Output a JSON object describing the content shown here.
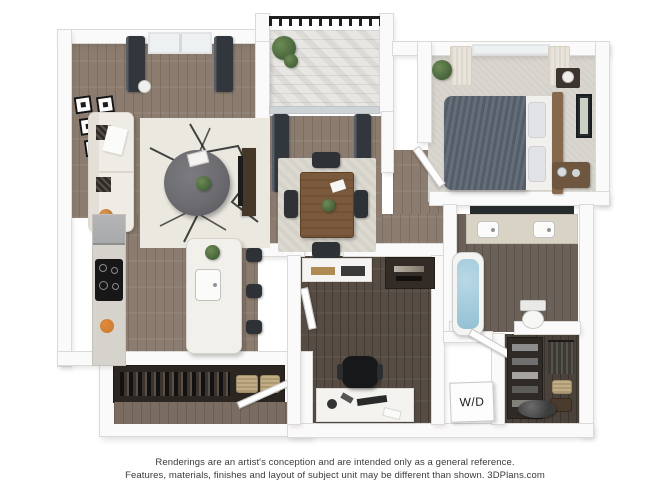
{
  "floorplan": {
    "type": "3d-apartment-floor-plan-rendering",
    "labels": {
      "washer_dryer": "W/D"
    },
    "rooms": [
      "living-room",
      "dining-area",
      "kitchen",
      "balcony",
      "bedroom",
      "bathroom",
      "den-office",
      "entry",
      "walk-in-closet",
      "laundry-nook"
    ],
    "furniture": [
      "sofa",
      "gallery-wall-frames",
      "area-rug",
      "round-ottoman",
      "media-console",
      "kitchen-island",
      "bar-stools",
      "cooktop",
      "refrigerator",
      "dining-table",
      "dining-chairs",
      "bed",
      "nightstand",
      "wall-art",
      "dresser",
      "double-vanity",
      "bathtub",
      "toilet",
      "desk",
      "office-chair",
      "closet-shelving",
      "baskets"
    ]
  },
  "disclaimer": {
    "line1": "Renderings are an artist's conception and are intended only as a general reference.",
    "line2": "Features, materials, finishes and layout of subject unit may be different than shown. 3DPlans.com"
  },
  "colors": {
    "wall": "#fbfafa",
    "wall-edge": "#dcdad7",
    "wood": "#8b7c6f",
    "wood-seam": "#6f6257",
    "wood-mid": "#7a6c60",
    "wood-dark": "#564c43",
    "closet-floor": "#4a423b",
    "carpet": "#d9d6d0",
    "bath-floor": "#6b6158",
    "deck": "#e8e6e2",
    "curtain-dark": "#3d434c",
    "curtain-light": "#e9e4da",
    "rug-living": "#ebe8e0",
    "rug-dining": "#dcd9d1",
    "duvet": "#59636f",
    "linen": "#f1f0ed",
    "pillow": "#e2e3e6",
    "headboard": "#86684c",
    "table-wood": "#7a593c",
    "chair-dark": "#2e3237",
    "ottoman": "#6c6b70",
    "console-wood": "#463829",
    "counter": "#d6d3cd",
    "island": "#f2f0ea",
    "cooktop": "#171717",
    "fridge": "#a8a9ab",
    "accent-orange": "#c9762e",
    "water": "#93c0d4",
    "vanity-top": "#d9d3c5",
    "mirror": "#262b2e",
    "plant": "#4c6a3e",
    "basket": "#c3ad85",
    "rail": "#1f1f1f",
    "text": "#3a3a3a",
    "label": "#1b1b1b"
  }
}
